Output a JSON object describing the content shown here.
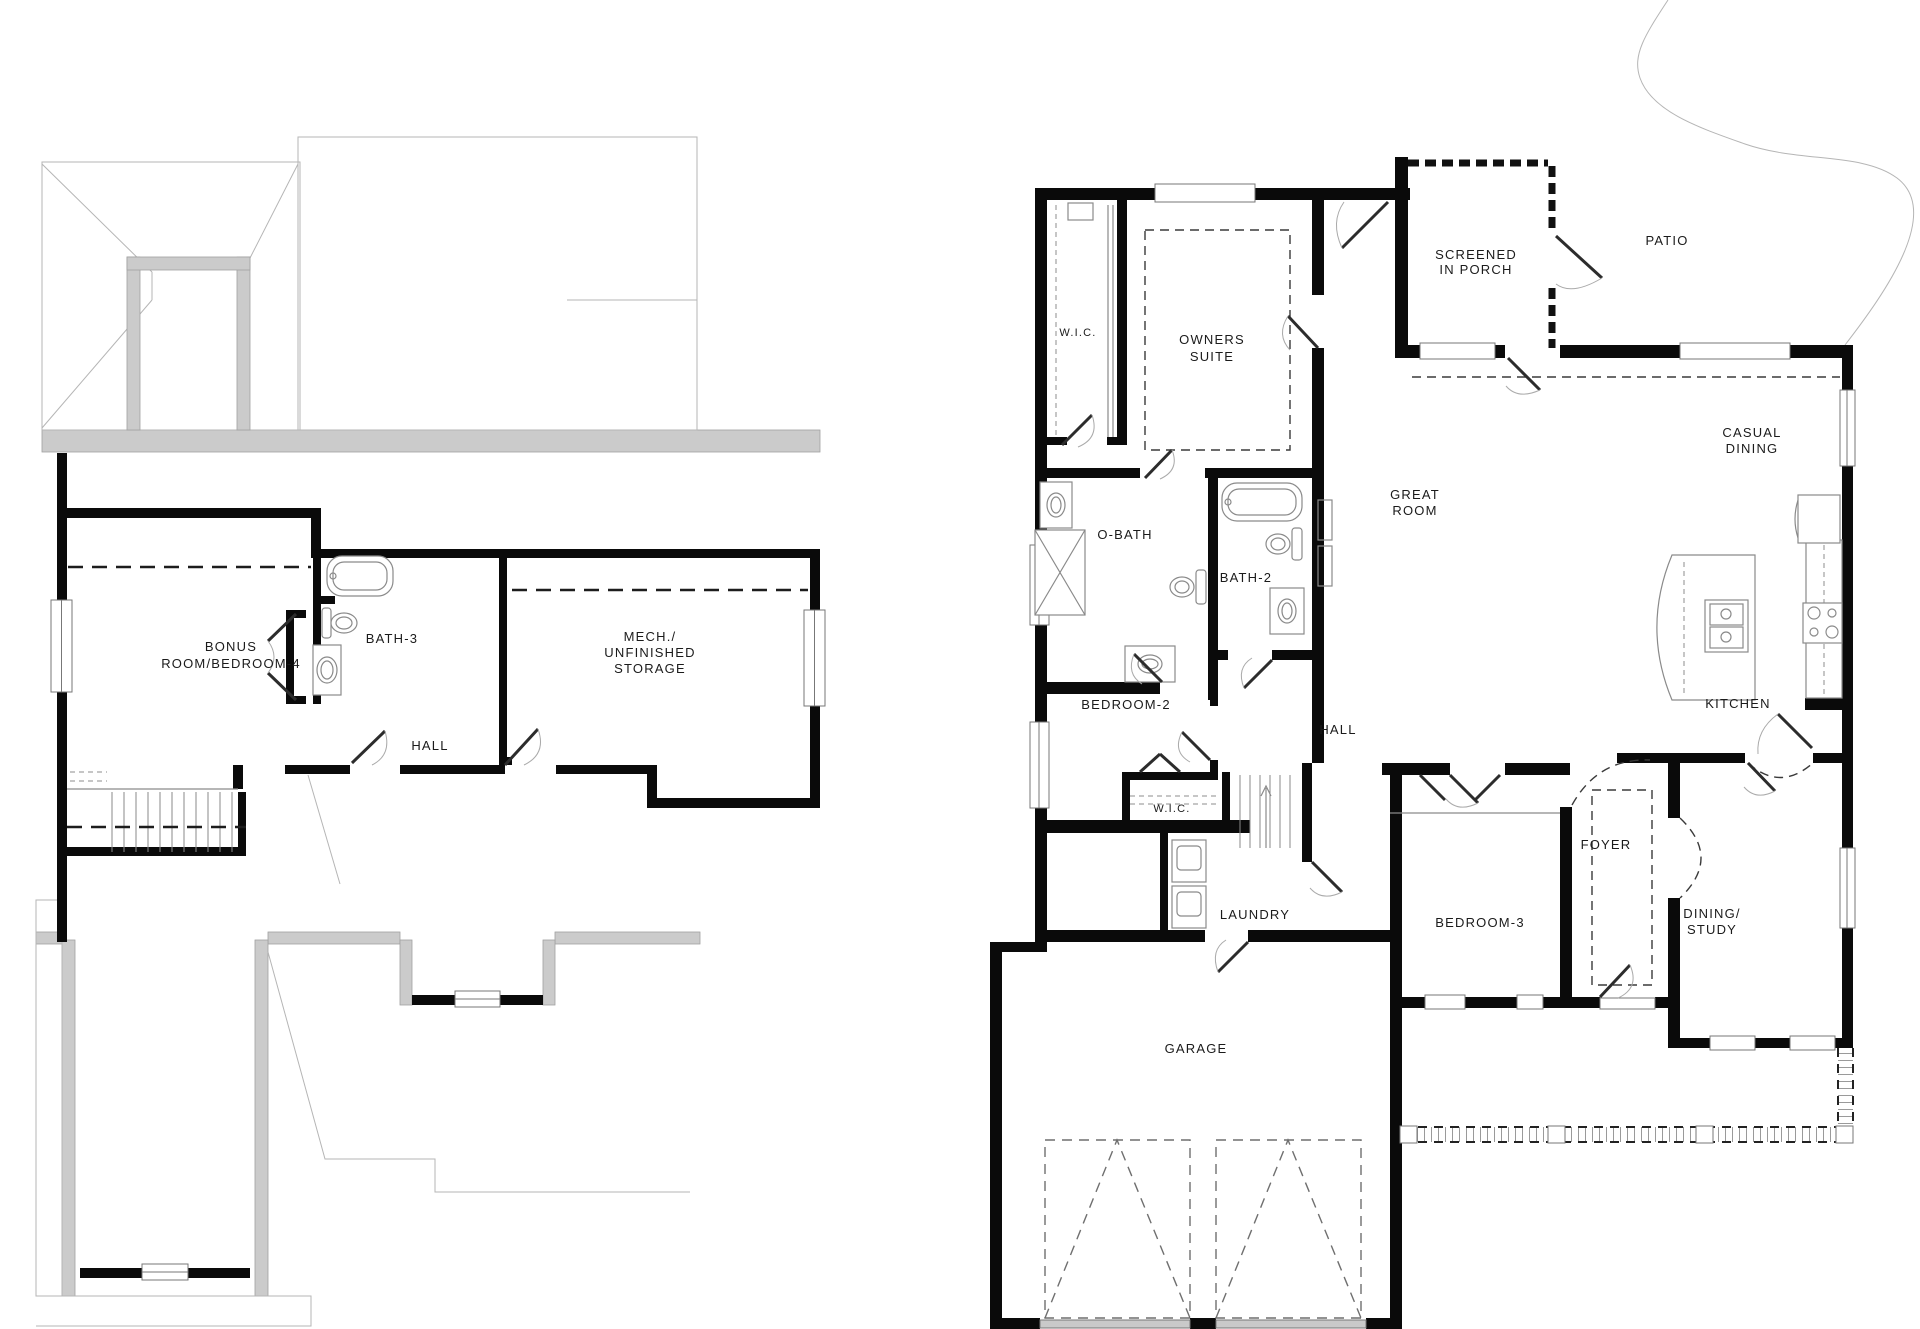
{
  "document": {
    "type": "architectural floor plan",
    "sheets": 2
  },
  "colors": {
    "wall": "#0a0a0a",
    "roof_band": "#cbcbcb",
    "roof_line": "#b5b5b5",
    "fixture_line": "#8a8a8a",
    "text": "#1b1b1b",
    "background": "#ffffff"
  },
  "left_plan": {
    "name": "upper floor plan",
    "labels": {
      "bonus1": "BONUS",
      "bonus2": "ROOM/BEDROOM-4",
      "bath3": "BATH-3",
      "hall": "HALL",
      "mech1": "MECH./",
      "mech2": "UNFINISHED",
      "mech3": "STORAGE"
    }
  },
  "right_plan": {
    "name": "main floor plan",
    "labels": {
      "wic_upper": "W.I.C.",
      "owners1": "OWNERS",
      "owners2": "SUITE",
      "screened1": "SCREENED",
      "screened2": "IN PORCH",
      "patio": "PATIO",
      "casual1": "CASUAL",
      "casual2": "DINING",
      "great1": "GREAT",
      "great2": "ROOM",
      "obath": "O-BATH",
      "bath2": "BATH-2",
      "bedroom2": "BEDROOM-2",
      "hall": "HALL",
      "kitchen": "KITCHEN",
      "wic_lower": "W.I.C.",
      "laundry": "LAUNDRY",
      "foyer": "FOYER",
      "bedroom3": "BEDROOM-3",
      "dining1": "DINING/",
      "dining2": "STUDY",
      "garage": "GARAGE"
    }
  }
}
